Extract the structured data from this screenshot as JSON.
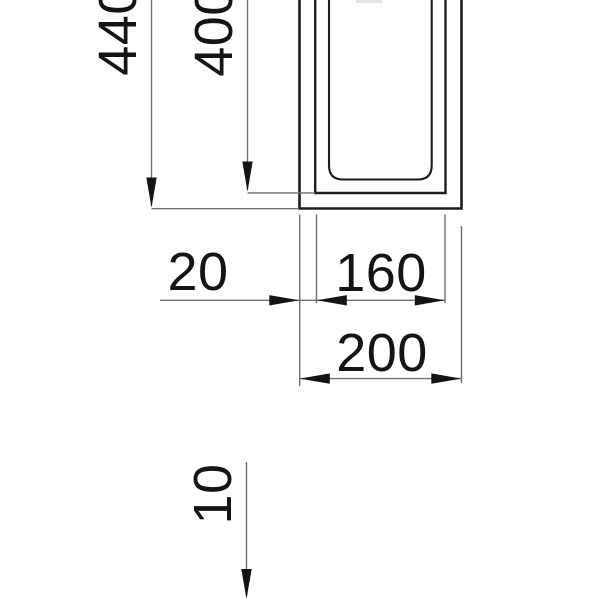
{
  "drawing": {
    "labels": {
      "height_overall": "440",
      "depth_inner": "400",
      "wall_thickness": "20",
      "width_inner": "160",
      "width_outer": "200",
      "thickness_bottom": "10"
    },
    "colors": {
      "background": "#ffffff",
      "profile_line": "#1e1e1e",
      "dimension_line": "#707070",
      "text_and_arrows": "#141414"
    }
  }
}
